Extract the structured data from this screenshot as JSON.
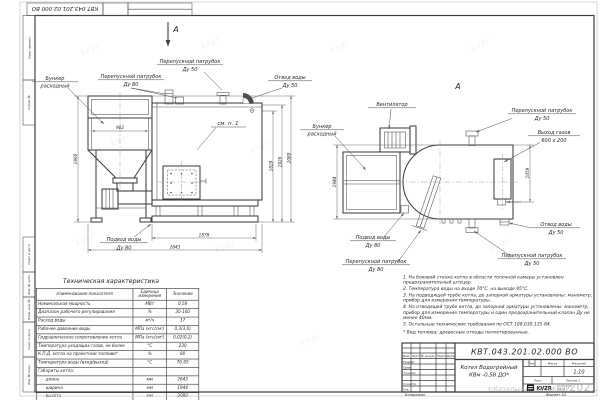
{
  "sheet": {
    "stamp_designation": "КВТ.043.201.02.000  ВО",
    "margin_labels": [
      "Перв. примен.",
      "Справ. №",
      "Подп. и дата",
      "Инв. № дубл.",
      "Взам. инв. №",
      "Подп. и дата",
      "Инв. № подл."
    ],
    "footer": {
      "copied": "Копировал",
      "format": "Формат  А3"
    },
    "watermark_tile": "kvzr",
    "copyright_prefix": "©КотельныйЗаводКВЗР",
    "copyright_year": "2021"
  },
  "front_view": {
    "section_mark": "А",
    "bunker_l1": "Бункер",
    "bunker_l2": "расходный",
    "bypass80_l1": "Перепускной патрубок",
    "bypass80_l2": "Ду 80",
    "bypass50_l1": "Перепускной патрубок",
    "bypass50_l2": "Ду 50",
    "water_out_l1": "Отвод воды",
    "water_out_l2": "Ду 50",
    "see_note": "см. п. 1",
    "water_in_l1": "Подвод воды",
    "water_in_l2": "Ду 80",
    "dims": {
      "bunker_height": "1960",
      "bunker_width": "902",
      "h_outlet": "1829",
      "h_elbow": "1929",
      "h_total": "2080",
      "base_length": "1878",
      "total_length": "2643"
    }
  },
  "side_view": {
    "view_mark": "А",
    "fan_label": "Вентилятор",
    "bunker_l1": "Бункер",
    "bunker_l2": "расходный",
    "bypass50_top_l1": "Перепускной патрубок",
    "bypass50_top_l2": "Ду 50",
    "gas_out_l1": "Выход газов",
    "gas_out_l2": "600 х 200",
    "water_out_l1": "Отвод воды",
    "water_out_l2": "Ду 50",
    "bypass50_bottom_l1": "Перепускной патрубок",
    "bypass50_bottom_l2": "Ду 50",
    "water_in_l1": "Подвод воды",
    "water_in_l2": "Ду 80",
    "bypass80_l1": "Перепускной патрубок",
    "bypass80_l2": "Ду 80",
    "dims": {
      "width": "1944",
      "gas_offset": "1059"
    }
  },
  "spec_table": {
    "title": "Техническая характеристика",
    "headers": {
      "name": "Наименование показателя",
      "unit": "Единица\nизмерения",
      "value": "Значение"
    },
    "rows": [
      {
        "name": "Номинальная мощность",
        "unit": "МВт",
        "value": "0,58"
      },
      {
        "name": "Диапазон рабочего регулирования",
        "unit": "%",
        "value": "30-100"
      },
      {
        "name": "Расход воды",
        "unit": "м³/ч",
        "value": "17"
      },
      {
        "name": "Рабочее давление воды",
        "unit": "МПа (кгс/см²)",
        "value": "0,3(3,0)"
      },
      {
        "name": "Гидравлическое сопротивление котла",
        "unit": "МПа (кгс/см²)",
        "value": "0,02(0,2)"
      },
      {
        "name": "Температура уходящих газов, не более",
        "unit": "°С",
        "value": "230"
      },
      {
        "name": "К.П.Д. котла на проектном топливе*",
        "unit": "%",
        "value": "80"
      },
      {
        "name": "Температура воды (вход/выход)",
        "unit": "°С",
        "value": "70-95"
      },
      {
        "name": "Габариты котла:",
        "unit": "",
        "value": ""
      },
      {
        "name": "- длина",
        "unit": "мм",
        "value": "2643"
      },
      {
        "name": "- ширина",
        "unit": "мм",
        "value": "1944"
      },
      {
        "name": "- высота",
        "unit": "мм",
        "value": "2080"
      }
    ]
  },
  "notes": {
    "items": [
      "1. На боковой стенке котла в области топочной камеры установлен предохранительный штуцер.",
      "2. Температура воды на входе 70°С, на выходе 95°С.",
      "3. На подводящей трубе котла, до запорной арматуры установлены: манометр, прибор для измерения температуры.",
      "4. На отводящей трубе котла, до запорной арматуры установлены: манометр, прибор для измерения температуры и один предохранительный клапан Ду не менее 40мм.",
      "5. Остальные технические требования по ОСТ 108.030.135-84."
    ],
    "footnote": "* Вид топлива: древесные отходы пеллетированные."
  },
  "title_block": {
    "designation": "КВТ.043.201.02.000  ВО",
    "product_l1": "Котел Водогрейный",
    "product_l2": "КВм -0,58 ДО*",
    "rev_headers": [
      "Изм.",
      "Лист",
      "№ докум.",
      "Подп.",
      "Дата"
    ],
    "row_labels": [
      "Разраб.",
      "Пров.",
      "Т.контр.",
      "Н.контр.",
      "Утв."
    ],
    "lit_label": "Лит.",
    "mass_label": "Масса",
    "scale_label": "Масштаб",
    "scale_value": "1:10",
    "sheet_label": "Лист",
    "sheets_label": "Листов 1",
    "logo_text": "KVZR",
    "logo_caption_l1": "КОТЕЛЬНЫЙ",
    "logo_caption_l2": "ЗАВОД"
  }
}
